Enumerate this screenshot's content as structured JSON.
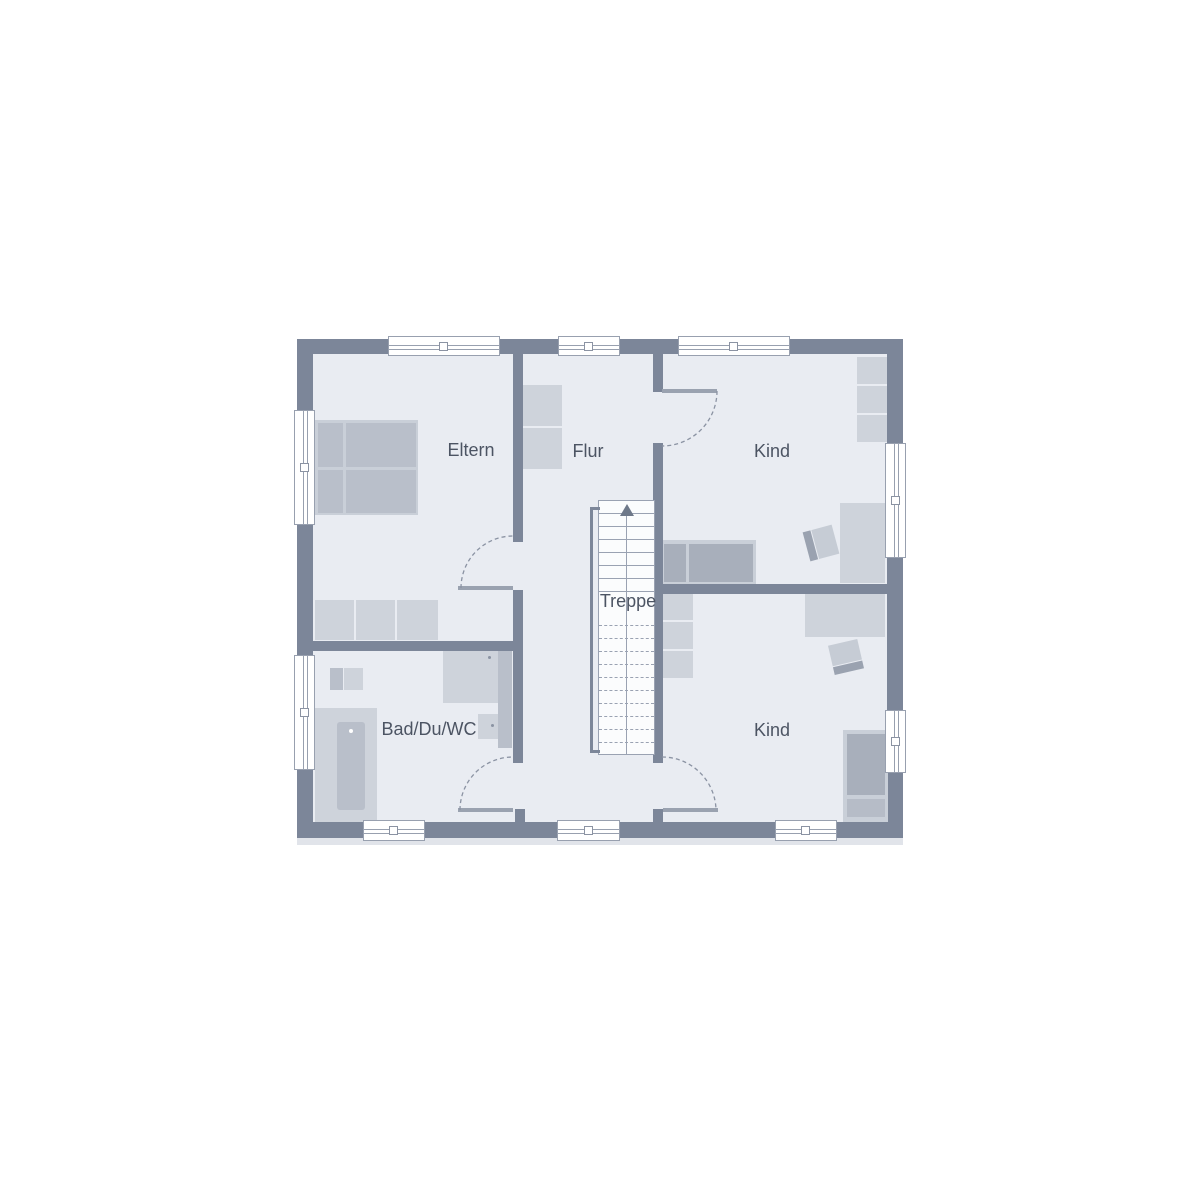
{
  "plan": {
    "type": "floor-plan",
    "labels": {
      "eltern": "Eltern",
      "flur": "Flur",
      "kind_top": "Kind",
      "treppe": "Treppe",
      "bad": "Bad/Du/WC",
      "kind_bottom": "Kind"
    },
    "colors": {
      "wall": "#7c8699",
      "floor": "#e9ecf2",
      "furniture_light": "#ced3db",
      "furniture_medium": "#b9bfca",
      "furniture_dark": "#a8afbb",
      "bed_base": "#c9cfd8",
      "line": "#98a0af",
      "text": "#4c5463",
      "window_fill": "#ffffff",
      "stair_fill": "#fbfcfd"
    }
  }
}
